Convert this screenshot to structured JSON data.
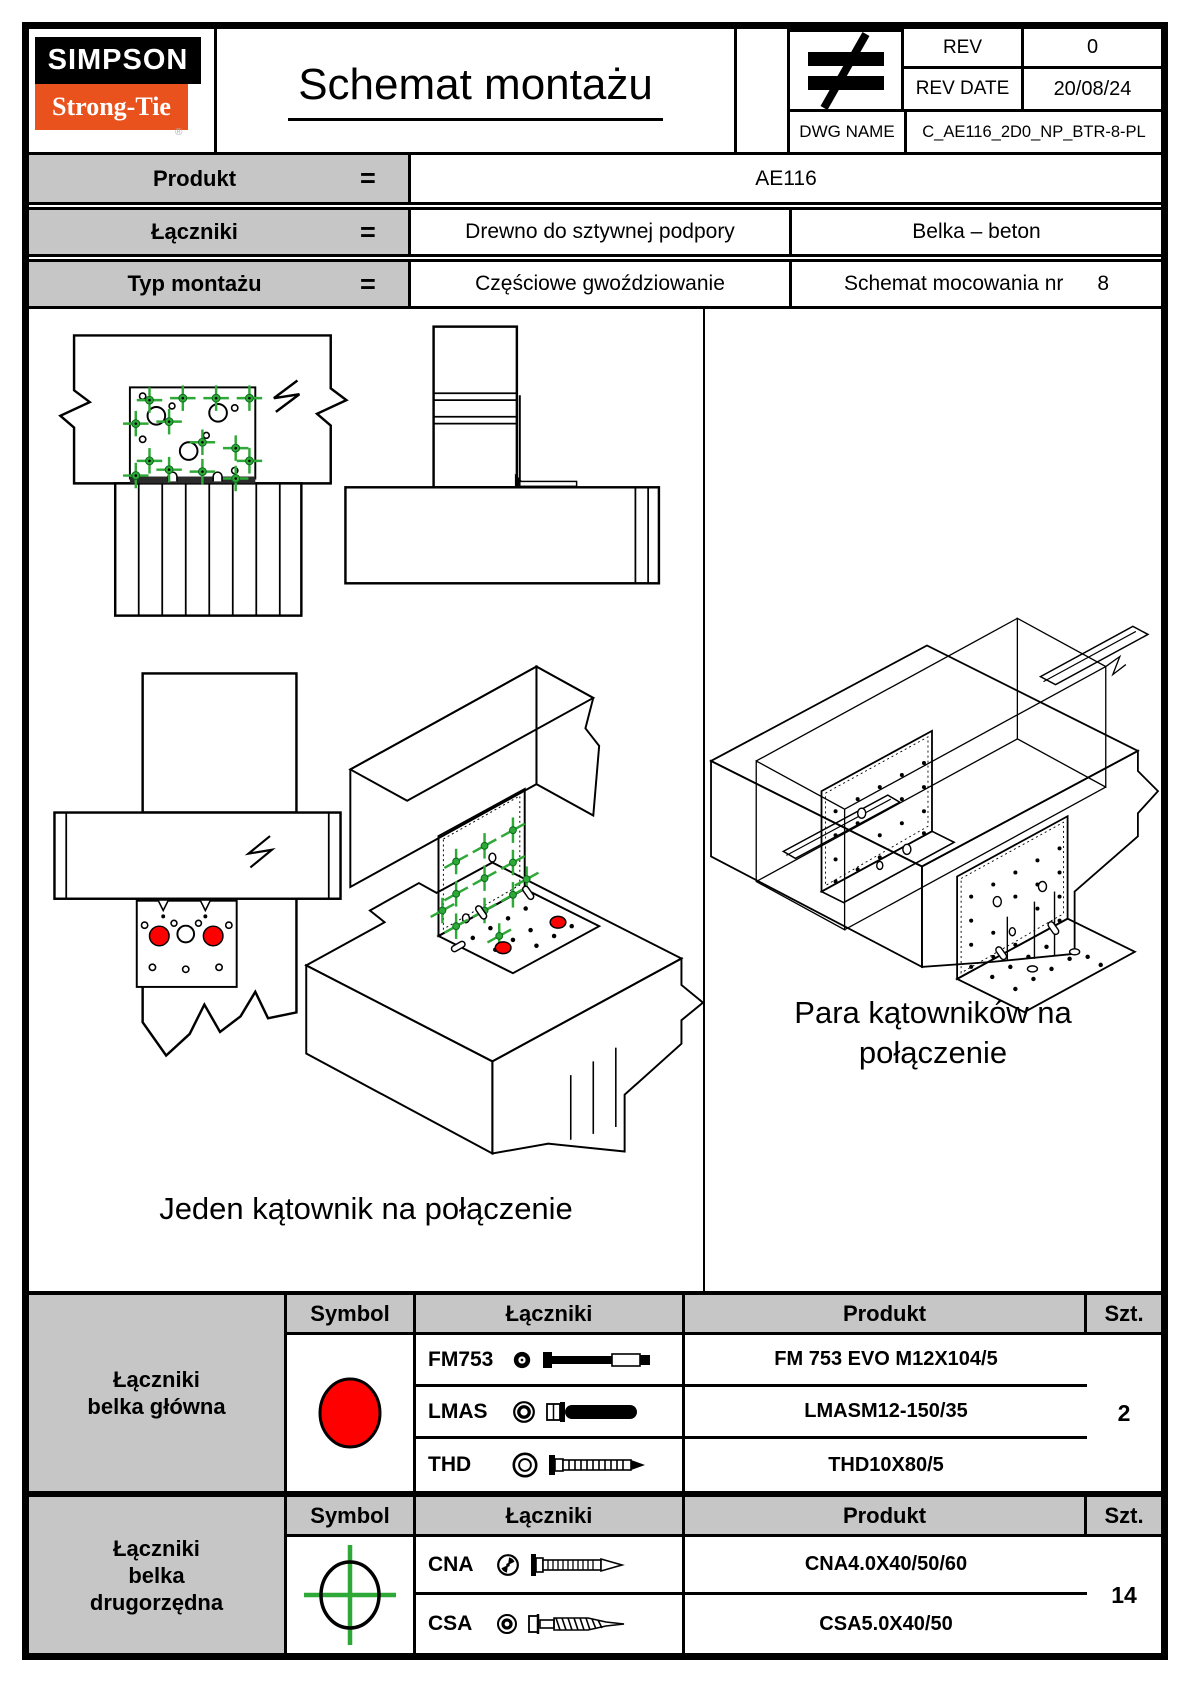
{
  "colors": {
    "orange": "#E9521D",
    "red": "#FF0000",
    "green": "#2EA836",
    "header_gray": "#C6C6C6"
  },
  "header": {
    "logo_top": "SIMPSON",
    "logo_bottom": "Strong-Tie",
    "registered_mark": "®",
    "title": "Schemat montażu",
    "projection_symbol": "≠",
    "rev": {
      "label": "REV",
      "value": "0"
    },
    "rev_date": {
      "label": "REV DATE",
      "value": "20/08/24"
    },
    "dwg": {
      "label": "DWG NAME",
      "value": "C_AE116_2D0_NP_BTR-8-PL"
    }
  },
  "info": {
    "rows": [
      {
        "label": "Produkt",
        "eq": "=",
        "value_full": "AE116"
      },
      {
        "label": "Łączniki",
        "eq": "=",
        "value_left": "Drewno do sztywnej podpory",
        "value_right": "Belka – beton"
      },
      {
        "label": "Typ montażu",
        "eq": "=",
        "value_left": "Częściowe gwoździowanie",
        "value_right": "Schemat mocowania nr",
        "value_right_number": "8"
      }
    ]
  },
  "drawings": {
    "left_caption": "Jeden kątownik na połączenie",
    "right_caption_line1": "Para kątowników na",
    "right_caption_line2": "połączenie"
  },
  "parts": {
    "headers": {
      "symbol": "Symbol",
      "fasteners": "Łączniki",
      "product": "Produkt",
      "qty": "Szt."
    },
    "main": {
      "label_line1": "Łączniki",
      "label_line2": "belka główna",
      "symbol": "red-filled-circle",
      "rows": [
        {
          "code": "FM753",
          "product": "FM 753 EVO M12X104/5"
        },
        {
          "code": "LMAS",
          "product": "LMASM12-150/35"
        },
        {
          "code": "THD",
          "product": "THD10X80/5"
        }
      ],
      "qty": "2"
    },
    "secondary": {
      "label_line1": "Łączniki",
      "label_line2": "belka",
      "label_line3": "drugorzędna",
      "symbol": "green-crosshair-circle",
      "rows": [
        {
          "code": "CNA",
          "product": "CNA4.0X40/50/60"
        },
        {
          "code": "CSA",
          "product": "CSA5.0X40/50"
        }
      ],
      "qty": "14"
    }
  }
}
